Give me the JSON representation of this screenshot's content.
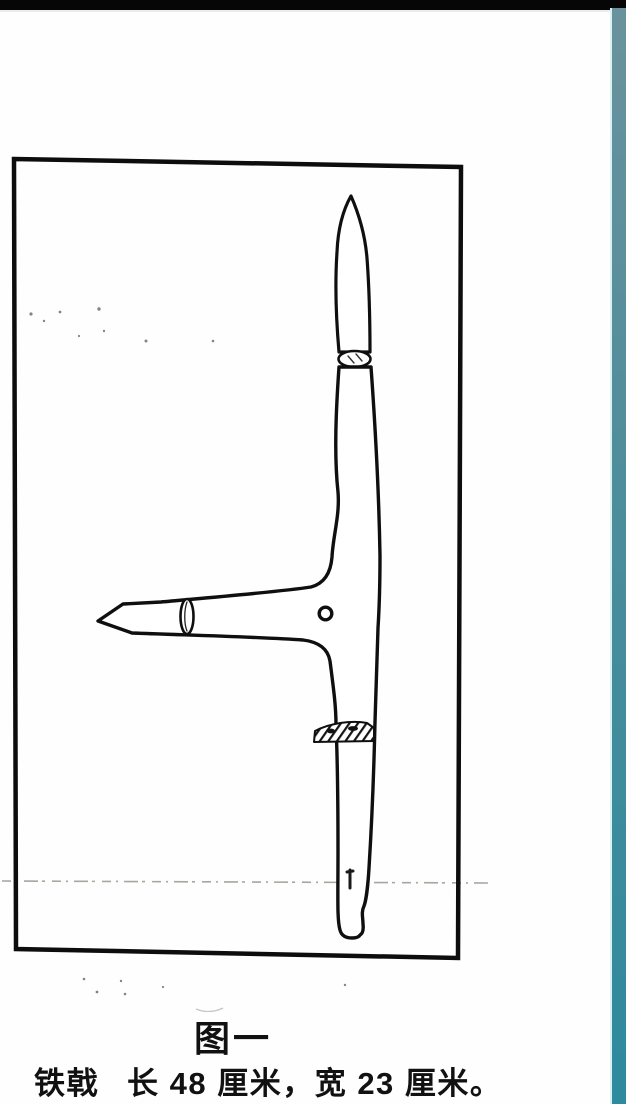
{
  "colors": {
    "top-bar": "#060606",
    "strip-top": "#6a929d",
    "strip-mid": "#4d8d9c",
    "strip-bottom": "#2e8a9d",
    "strip-edge": "#d8f2f2",
    "ink": "#111111"
  },
  "document": {
    "figure_caption": "图一",
    "artifact_name": "铁戟",
    "artifact_dimensions": "长 48 厘米，宽 23 厘米。",
    "drawing_subject": "iron halberd (tie ji) archaeological line drawing, T-shaped: vertical spike blade and shaft with two hatched socket bands, horizontal cross-blade with pointed tip, narrow collar ellipse and small round rivet hole"
  }
}
